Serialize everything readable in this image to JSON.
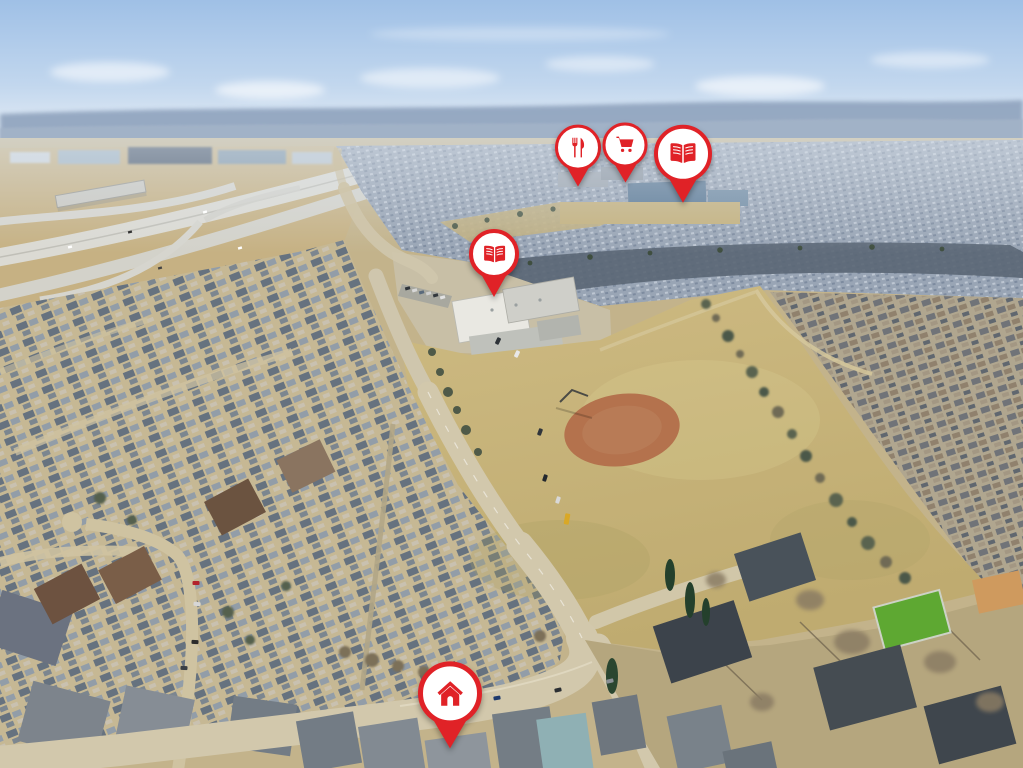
{
  "photo": {
    "kind": "aerial-neighbourhood-view",
    "colors": {
      "pin_red": "#e02227",
      "pin_white": "#ffffff",
      "sky_top": "#9fc0e6",
      "field_tan": "#c9b67e",
      "diamond_clay": "#b4724d",
      "turf_green": "#5ea832"
    }
  },
  "pins": [
    {
      "id": "restaurant",
      "icon": "restaurant",
      "x_pct": 56.5,
      "y_pct": 24.3,
      "size": 46
    },
    {
      "id": "grocery",
      "icon": "cart",
      "x_pct": 61.1,
      "y_pct": 23.8,
      "size": 45
    },
    {
      "id": "library",
      "icon": "book",
      "x_pct": 66.8,
      "y_pct": 26.4,
      "size": 58
    },
    {
      "id": "school",
      "icon": "book",
      "x_pct": 48.3,
      "y_pct": 38.7,
      "size": 50
    },
    {
      "id": "home",
      "icon": "home",
      "x_pct": 44.0,
      "y_pct": 97.4,
      "size": 64
    }
  ]
}
